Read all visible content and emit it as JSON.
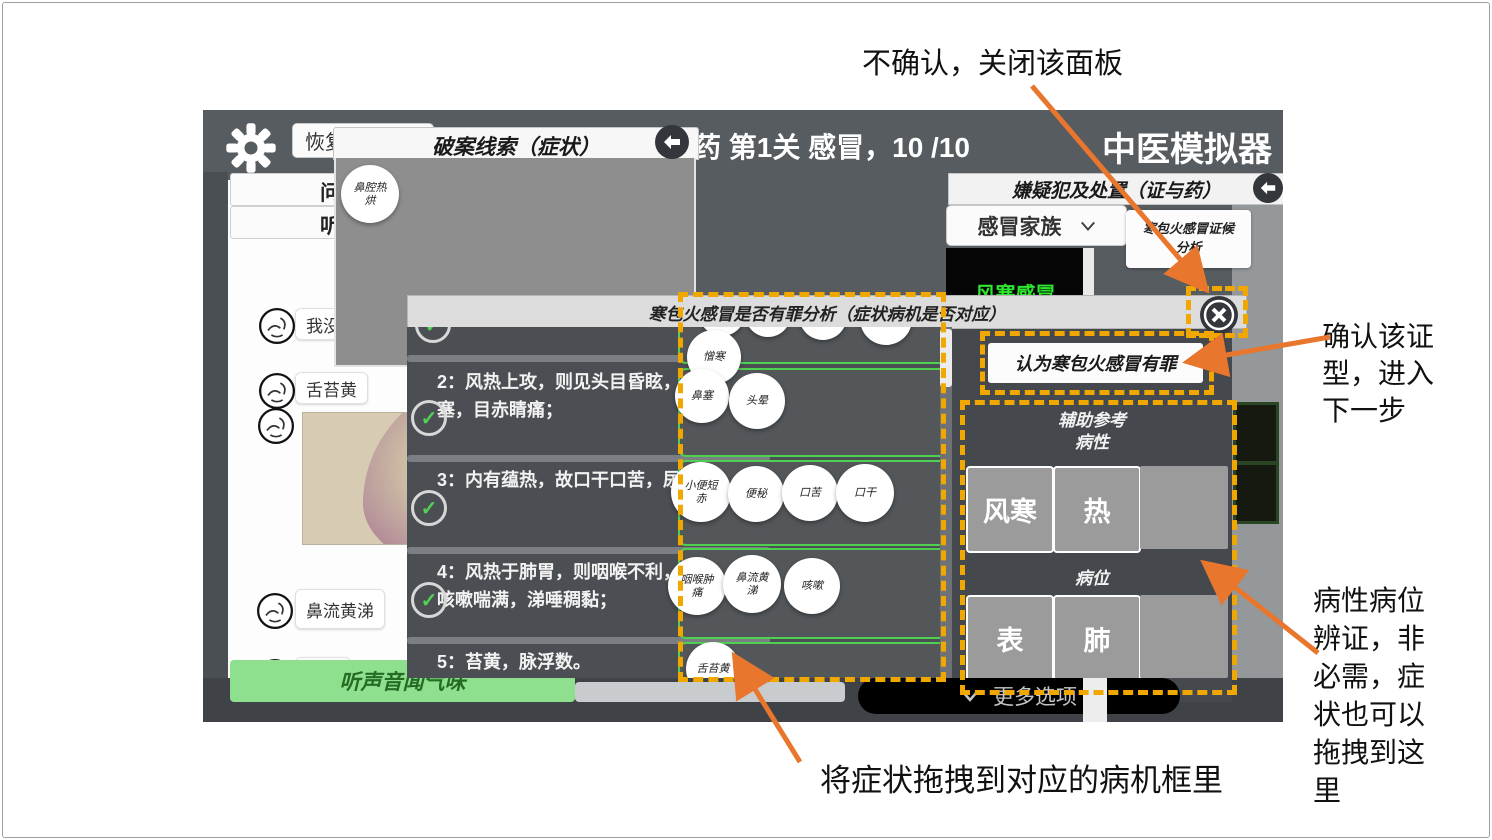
{
  "annotations": {
    "close_note": "不确认，关闭该面板",
    "confirm_note": "确认该证\n型，进入\n下一步",
    "aux_note": "病性病位\n辨证，非\n必需，症\n状也可以\n拖拽到这\n里",
    "drag_note": "将症状拖拽到对应的病机框里",
    "arrow_color": "#e8762c",
    "highlight_color": "#f0a800"
  },
  "window": {
    "restore_button": "恢复",
    "level_text": "药 第1关 感冒，10 /10",
    "app_title": "中医模拟器",
    "more_options": "更多选项"
  },
  "clue_panel": {
    "title": "破案线索（症状）",
    "symptom": "鼻腔热\n烘"
  },
  "chat": {
    "tab1": "问诊",
    "tab2": "听诊",
    "messages": [
      "我没有感冒",
      "舌苔黄",
      "鼻流黄涕",
      "鼻塞",
      "咳嗽"
    ],
    "listen_button": "听声音闻气味"
  },
  "dialog": {
    "title": "寒包火感冒是否有罪分析（症状病机是否对应）",
    "floating_symptom": "憎寒",
    "rows": [
      {
        "text": "2：风热上攻，则见头目昏眩，耳鸣，鼻塞，目赤睛痛；",
        "symptoms": [
          "鼻塞",
          "头晕"
        ]
      },
      {
        "text": "3：内有蕴热，故口干口苦，尿赤便秘；",
        "symptoms": [
          "小便短\n赤",
          "便秘",
          "口苦",
          "口干"
        ]
      },
      {
        "text": "4：风热于肺胃，则咽喉不利，胸膈痞闷，咳嗽喘满，涕唾稠黏；",
        "symptoms": [
          "咽喉肿\n痛",
          "鼻流黄\n涕",
          "咳嗽"
        ]
      },
      {
        "text": "5：苔黄，脉浮数。",
        "symptoms": [
          "舌苔黄"
        ]
      }
    ]
  },
  "suspect_panel": {
    "title": "嫌疑犯及处置（证与药）",
    "family_dropdown": "感冒家族",
    "note": "寒包火感冒证候\n分析",
    "suspect_name": "风寒感冒",
    "suspect_color": "#2ee62e",
    "guilty_button": "认为寒包火感冒有罪",
    "aux_header": "辅助参考\n病性",
    "nature_options": [
      "风寒",
      "热"
    ],
    "location_header": "病位",
    "location_options": [
      "表",
      "肺"
    ]
  }
}
